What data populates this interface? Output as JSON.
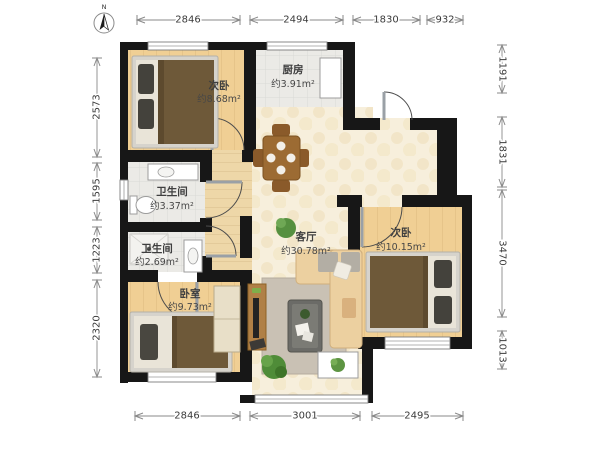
{
  "compass": {
    "label": "N"
  },
  "dimensions": {
    "top": [
      "2846",
      "2494",
      "1830",
      "932"
    ],
    "bottom": [
      "2846",
      "3001",
      "2495"
    ],
    "left": [
      "2573",
      "1595",
      "1223",
      "2320"
    ],
    "right": [
      "1191",
      "1831",
      "3470",
      "1013"
    ]
  },
  "rooms": {
    "bedroom_nw": {
      "name": "次卧",
      "area": "约8.68m²"
    },
    "kitchen": {
      "name": "厨房",
      "area": "约3.91m²"
    },
    "bath_1": {
      "name": "卫生间",
      "area": "约3.37m²"
    },
    "bath_2": {
      "name": "卫生间",
      "area": "约2.69m²"
    },
    "bedroom_sw": {
      "name": "卧室",
      "area": "约9.73m²"
    },
    "living": {
      "name": "客厅",
      "area": "约30.78m²"
    },
    "bedroom_ne": {
      "name": "次卧",
      "area": "约10.15m²"
    }
  },
  "colors": {
    "wall": "#171717",
    "wood_floor": "#f0cf94",
    "hall_floor": "#eed7a8",
    "tile_floor": "#ebeae6",
    "marble_floor": "#f7efdc",
    "bed_blanket": "#6e5939",
    "furniture_wood": "#9c6b33",
    "sofa": "#ecd0a0",
    "rug": "#c9c1b4",
    "plant": "#4f8c38"
  }
}
